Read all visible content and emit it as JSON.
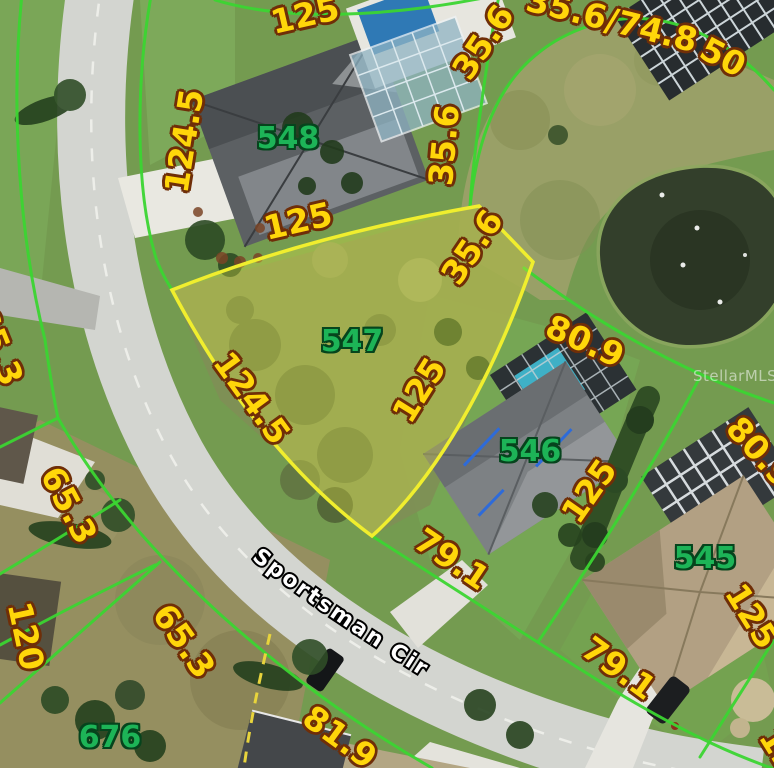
{
  "street": {
    "name": "Sportsman Cir"
  },
  "watermark": {
    "text": "StellarMLS"
  },
  "highlighted_lot": {
    "parcel_id": "547"
  },
  "parcels": [
    {
      "id": "548",
      "x": 288,
      "y": 139
    },
    {
      "id": "547",
      "x": 352,
      "y": 342
    },
    {
      "id": "546",
      "x": 530,
      "y": 452
    },
    {
      "id": "545",
      "x": 705,
      "y": 559
    },
    {
      "id": "676",
      "x": 110,
      "y": 738
    }
  ],
  "dimensions": [
    {
      "text": "125",
      "x": 305,
      "y": 15,
      "rot": -13
    },
    {
      "text": "35.6",
      "x": 483,
      "y": 42,
      "rot": -56
    },
    {
      "text": "35.6/74.8",
      "x": 612,
      "y": 20,
      "rot": 14
    },
    {
      "text": "50",
      "x": 723,
      "y": 57,
      "rot": 28
    },
    {
      "text": "124.5",
      "x": 184,
      "y": 141,
      "rot": -81
    },
    {
      "text": "125",
      "x": 298,
      "y": 221,
      "rot": -13
    },
    {
      "text": "35.6",
      "x": 444,
      "y": 145,
      "rot": -85
    },
    {
      "text": "35.6",
      "x": 472,
      "y": 247,
      "rot": -56
    },
    {
      "text": "125",
      "x": 419,
      "y": 390,
      "rot": -58
    },
    {
      "text": "124.5",
      "x": 252,
      "y": 398,
      "rot": 54
    },
    {
      "text": "80.9",
      "x": 585,
      "y": 341,
      "rot": 24
    },
    {
      "text": "125",
      "x": 589,
      "y": 491,
      "rot": -55
    },
    {
      "text": "80.9",
      "x": 760,
      "y": 452,
      "rot": 48
    },
    {
      "text": "125",
      "x": 752,
      "y": 616,
      "rot": 58
    },
    {
      "text": "79.1",
      "x": 452,
      "y": 559,
      "rot": 34
    },
    {
      "text": "79.1",
      "x": 619,
      "y": 668,
      "rot": 36
    },
    {
      "text": "81.9",
      "x": 340,
      "y": 737,
      "rot": 36
    },
    {
      "text": "65.3",
      "x": 69,
      "y": 505,
      "rot": 62
    },
    {
      "text": "65.3",
      "x": 184,
      "y": 641,
      "rot": 55
    },
    {
      "text": "120",
      "x": 26,
      "y": 636,
      "rot": 78
    },
    {
      "text": "65.3",
      "x": -2,
      "y": 346,
      "rot": 68
    },
    {
      "text": "125",
      "x": 786,
      "y": 760,
      "rot": 58
    }
  ],
  "colors": {
    "dimension_text": "#ffd60a",
    "dimension_outline": "#6f2e08",
    "parcel_number_text": "#1db457",
    "parcel_number_outline": "#06441d",
    "parcel_line_green": "#3bd531",
    "highlight_border": "#f0ee2e",
    "highlight_fill": "rgba(236,236,70,0.32)",
    "dashed_line_yellow": "#e8d43c",
    "street_text": "#ffffff"
  }
}
